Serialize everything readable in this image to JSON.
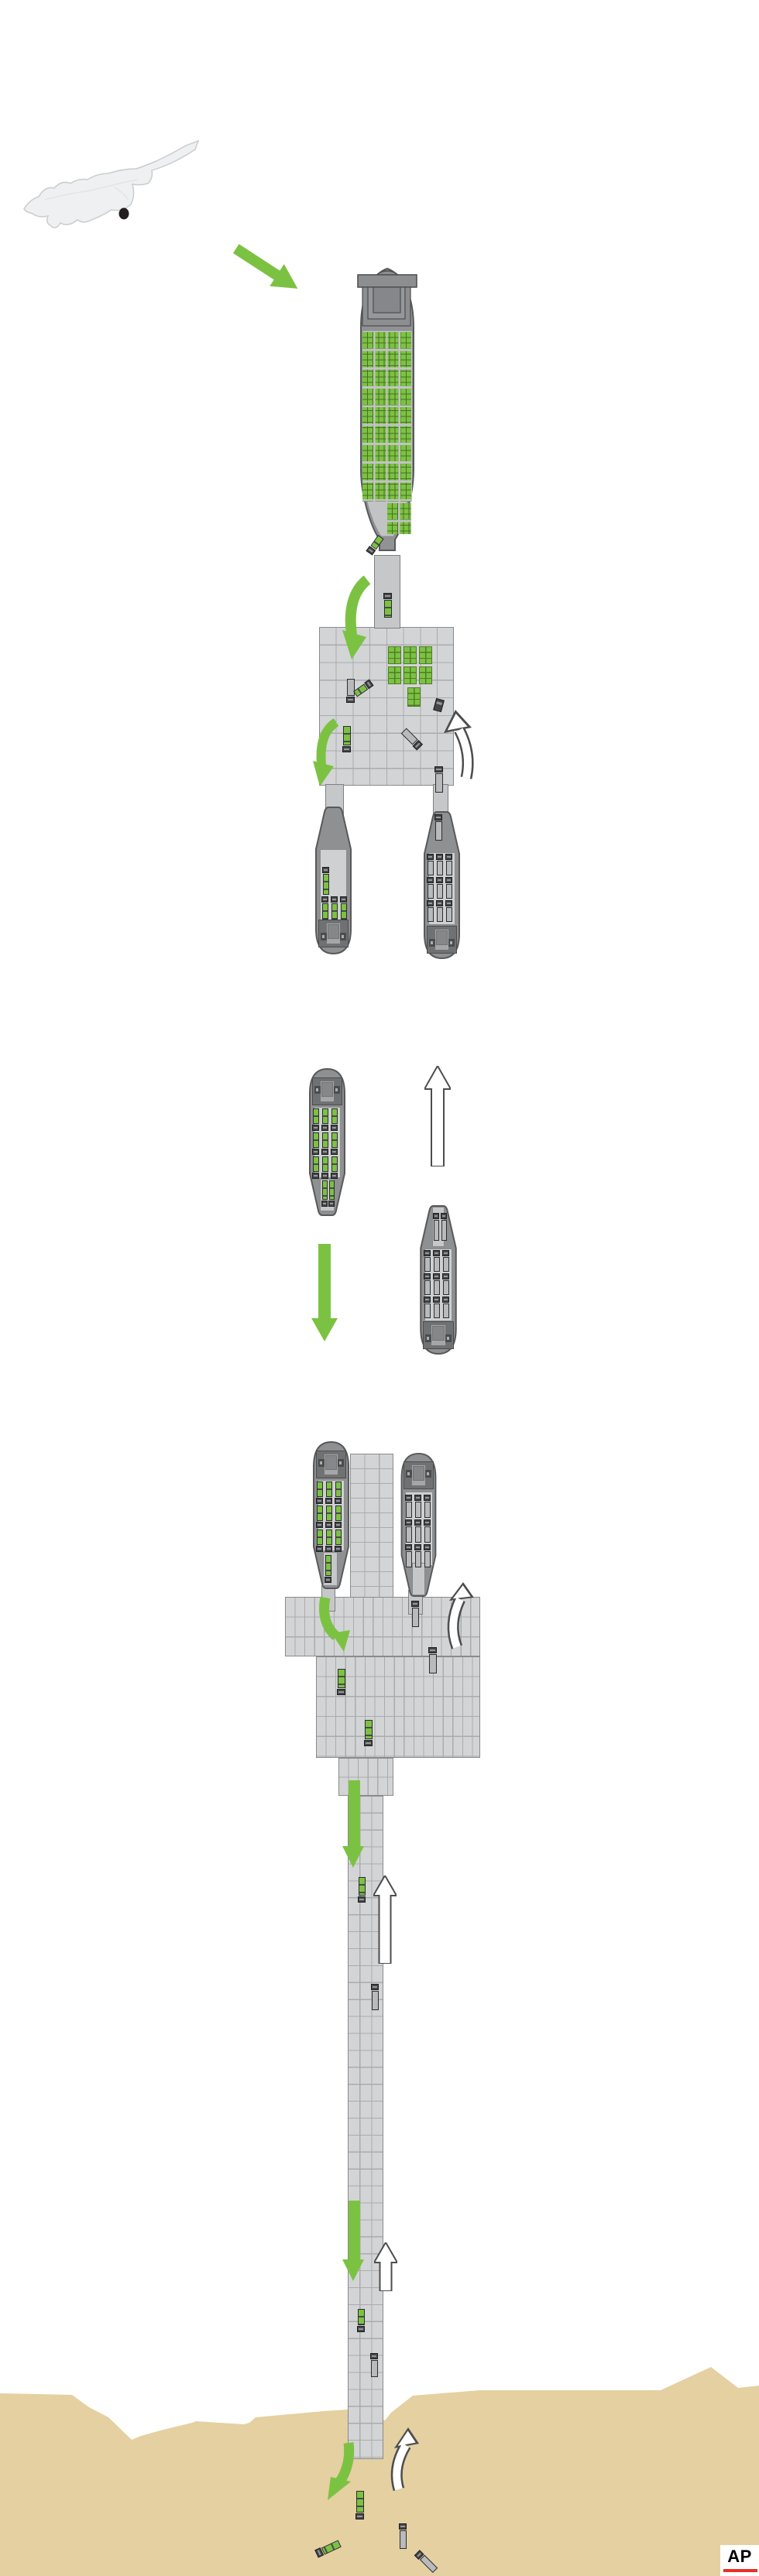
{
  "branding": {
    "logo_text": "AP"
  },
  "colors": {
    "accent_green": "#7cc242",
    "green_dark": "#4f7d27",
    "sand": "#e4d0a1",
    "dock_fill": "#d3d4d6",
    "dock_line": "#a9abad",
    "hull": "#909294",
    "hull_dark": "#58595b",
    "deck": "#c2c3c5",
    "truck_dark": "#454648",
    "white_arrow_outline": "#4d4d4f",
    "map_fill": "#eef0f1",
    "map_outline": "#c9cdce",
    "marker": "#231f20",
    "logo_red": "#ec2e25"
  },
  "scene": {
    "map": {
      "island": "cyprus-silhouette",
      "marker": "origin-port-dot"
    },
    "flow_semantics": {
      "green_solid_arrow": "loaded-aid-flow-toward-shore",
      "white_outlined_arrow": "empty-return-flow"
    },
    "cargo_ship": {
      "state": "loaded",
      "container_group_columns": 4,
      "container_group_rows": 9,
      "boxes_per_group": 6,
      "extra_partial_groups": 2,
      "deck_trucks": 2
    },
    "transfer_platform": {
      "container_stacks": 7,
      "trucks": 6,
      "berthed_vessels": 2
    },
    "shuttle_vessel_loaded": {
      "deck_trucks": 11,
      "truck_state": "loaded"
    },
    "shuttle_vessel_empty": {
      "deck_trucks": 11,
      "truck_state": "empty"
    },
    "nearshore_platform": {
      "trucks": 3,
      "berthed_vessels": 2
    },
    "causeway": {
      "lanes": 2,
      "trucks": 4
    },
    "beach": {
      "trucks": 4
    }
  }
}
